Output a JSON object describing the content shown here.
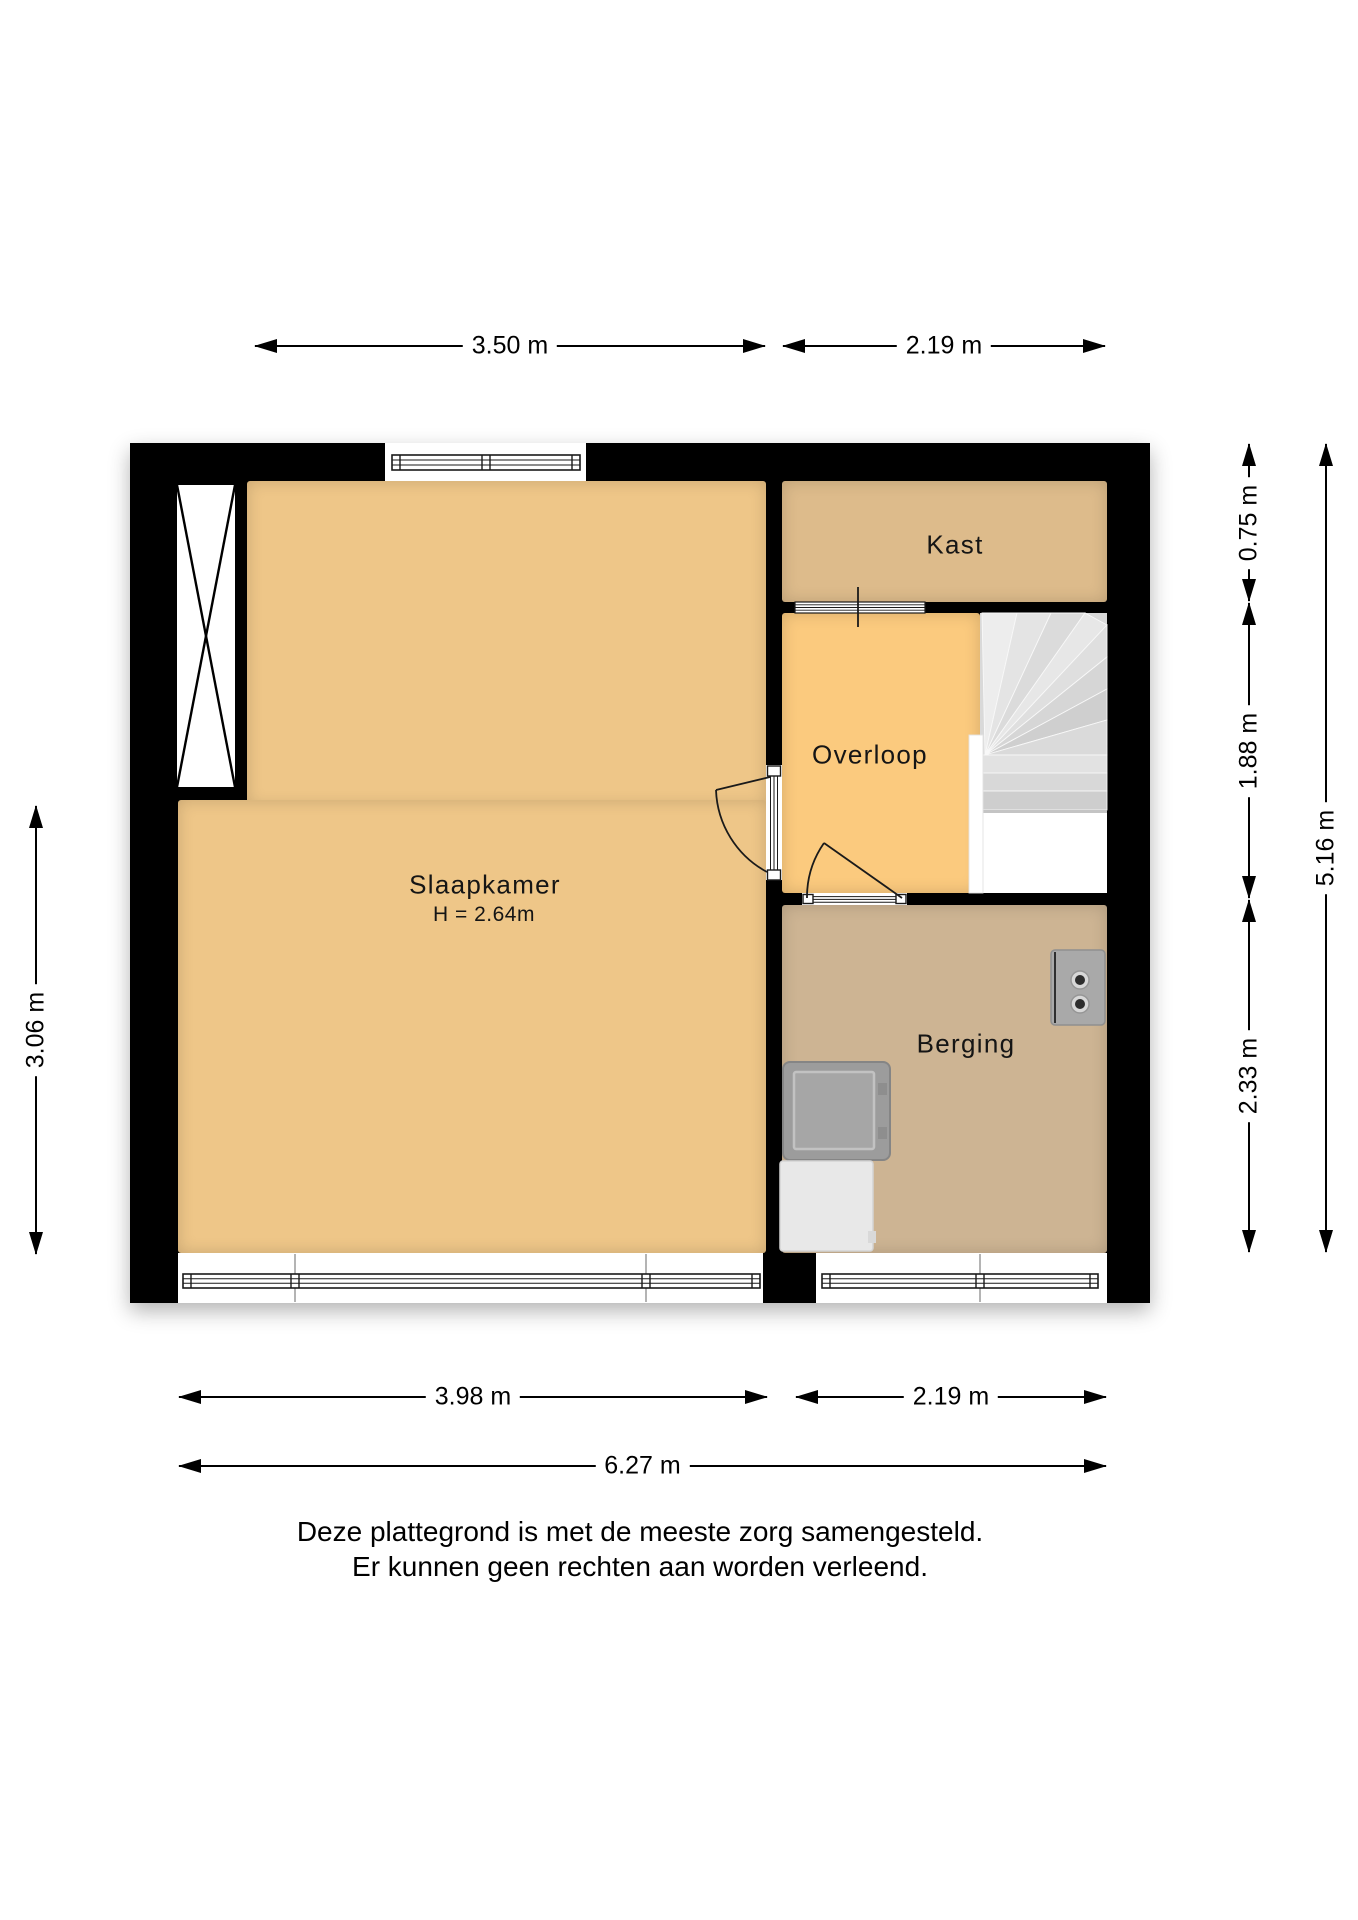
{
  "floorplan": {
    "rooms": {
      "slaapkamer": {
        "label": "Slaapkamer",
        "ceiling_height": "H = 2.64m"
      },
      "kast": {
        "label": "Kast"
      },
      "overloop": {
        "label": "Overloop"
      },
      "berging": {
        "label": "Berging"
      }
    },
    "dimensions": {
      "top_left": "3.50 m",
      "top_right": "2.19 m",
      "left": "3.06 m",
      "right_inner": [
        "0.75 m",
        "1.88 m",
        "2.33 m"
      ],
      "right_outer": "5.16 m",
      "bottom_left": "3.98 m",
      "bottom_right": "2.19 m",
      "bottom_total": "6.27 m"
    },
    "disclaimer": {
      "line1": "Deze plattegrond is met de meeste zorg samengesteld.",
      "line2": "Er kunnen geen rechten aan worden verleend."
    },
    "colors": {
      "wall": "#000000",
      "slaapkamer": "#eec688",
      "overloop": "#fbca7e",
      "kast": "#ddbb8b",
      "berging": "#cdb493",
      "stairs": "#d9d9d9",
      "window_frame": "#1a1a1a",
      "appliance_gray": "#9e9e9e",
      "boiler_gray": "#a9a9a9"
    },
    "symbols": [
      "duct-x-icon",
      "window-icon",
      "swing-door-icon",
      "sliding-door-icon",
      "winder-stairs-icon",
      "washing-machine-icon",
      "dryer-icon",
      "boiler-icon"
    ]
  }
}
